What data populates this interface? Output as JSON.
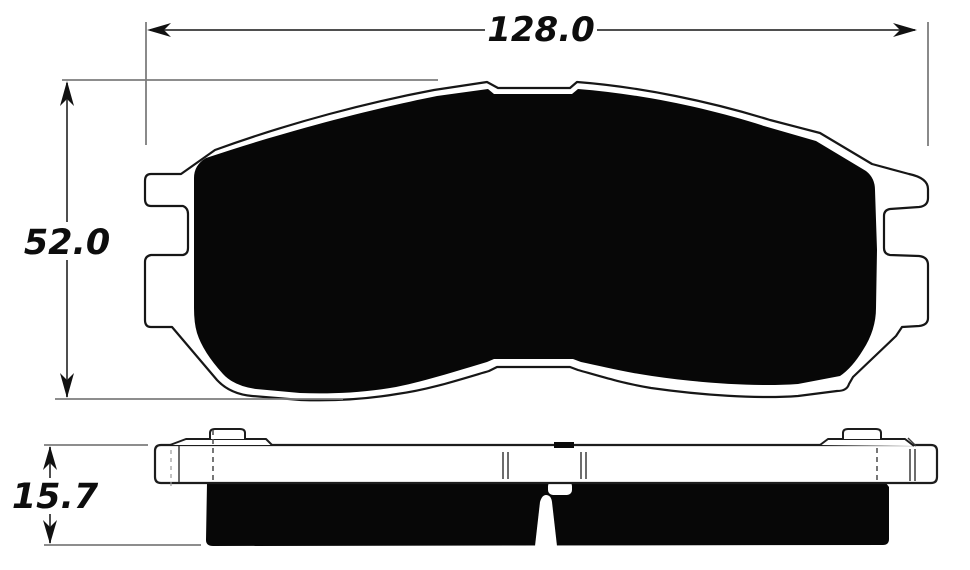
{
  "drawing": {
    "description": "Brake pad dimensional drawing, front profile and side section",
    "labels": {
      "width": "128.0",
      "height": "52.0",
      "thickness": "15.7"
    },
    "colors": {
      "background": "#ffffff",
      "ink": "#0d0d0d",
      "pad_fill": "#070707",
      "dimension_line": "#4f4f4f",
      "extension_line": "#7d7d7d"
    }
  }
}
